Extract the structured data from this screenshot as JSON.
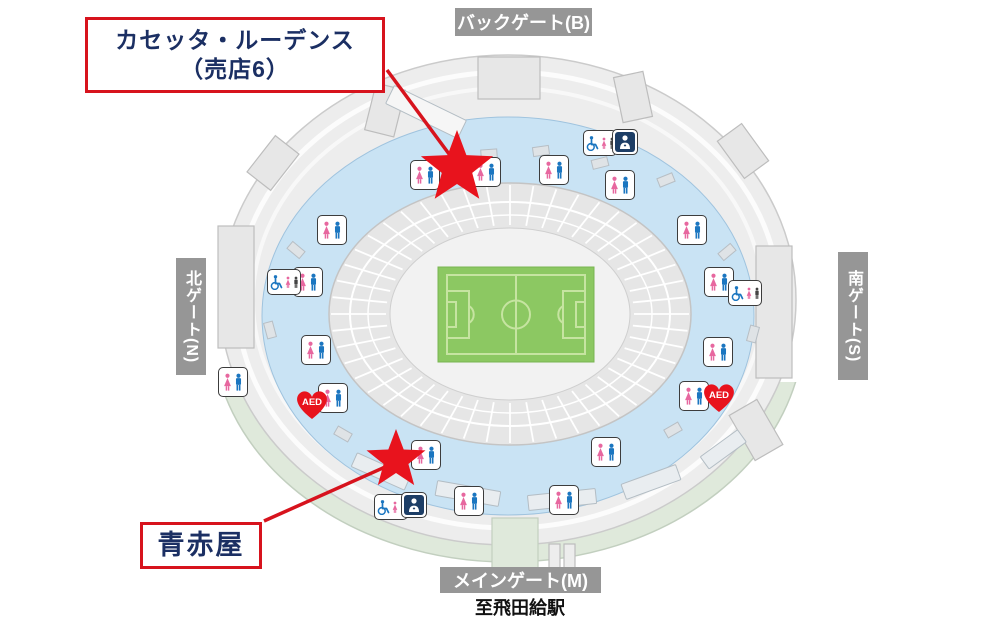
{
  "callouts": {
    "shop6": {
      "line1": "カセッタ・ルーデンス",
      "line2": "（売店6）"
    },
    "aoakaya": {
      "label": "青赤屋"
    }
  },
  "gates": {
    "back": "バックゲート(B)",
    "main": "メインゲート(M)",
    "north": "北ゲート(N)",
    "south": "南ゲート(S)"
  },
  "station_note": "至飛田給駅",
  "aed_label": "AED",
  "colors": {
    "accent_red": "#d7131d",
    "star_red": "#e8131d",
    "navy_text": "#1b2f63",
    "gate_gray": "#969696",
    "concourse_blue": "#c9e3f4",
    "stand_gray": "#e6e6e6",
    "outer_gray": "#ededed",
    "walkway_green": "#dfe9db",
    "field_green": "#8cc862",
    "field_line_green": "#c6e4a1",
    "restroom_pink": "#e7679f",
    "restroom_blue": "#1b76c0",
    "first_aid_navy": "#1d3e66"
  },
  "map_markers": {
    "restrooms": [
      [
        425,
        175
      ],
      [
        486,
        172
      ],
      [
        554,
        170
      ],
      [
        620,
        185
      ],
      [
        332,
        230
      ],
      [
        692,
        230
      ],
      [
        308,
        282
      ],
      [
        719,
        282
      ],
      [
        316,
        350
      ],
      [
        718,
        352
      ],
      [
        233,
        382
      ],
      [
        694,
        396
      ],
      [
        333,
        398
      ],
      [
        426,
        455
      ],
      [
        606,
        452
      ],
      [
        469,
        501
      ],
      [
        564,
        500
      ]
    ],
    "accessible_toilets": [
      [
        600,
        143
      ],
      [
        284,
        282
      ],
      [
        745,
        293
      ],
      [
        391,
        507
      ]
    ],
    "first_aid_rooms": [
      [
        625,
        142
      ],
      [
        414,
        505
      ]
    ],
    "aed": [
      [
        312,
        404
      ],
      [
        719,
        397
      ]
    ],
    "stars": [
      {
        "x": 457,
        "y": 168,
        "r": 38
      },
      {
        "x": 396,
        "y": 460,
        "r": 31
      }
    ]
  }
}
